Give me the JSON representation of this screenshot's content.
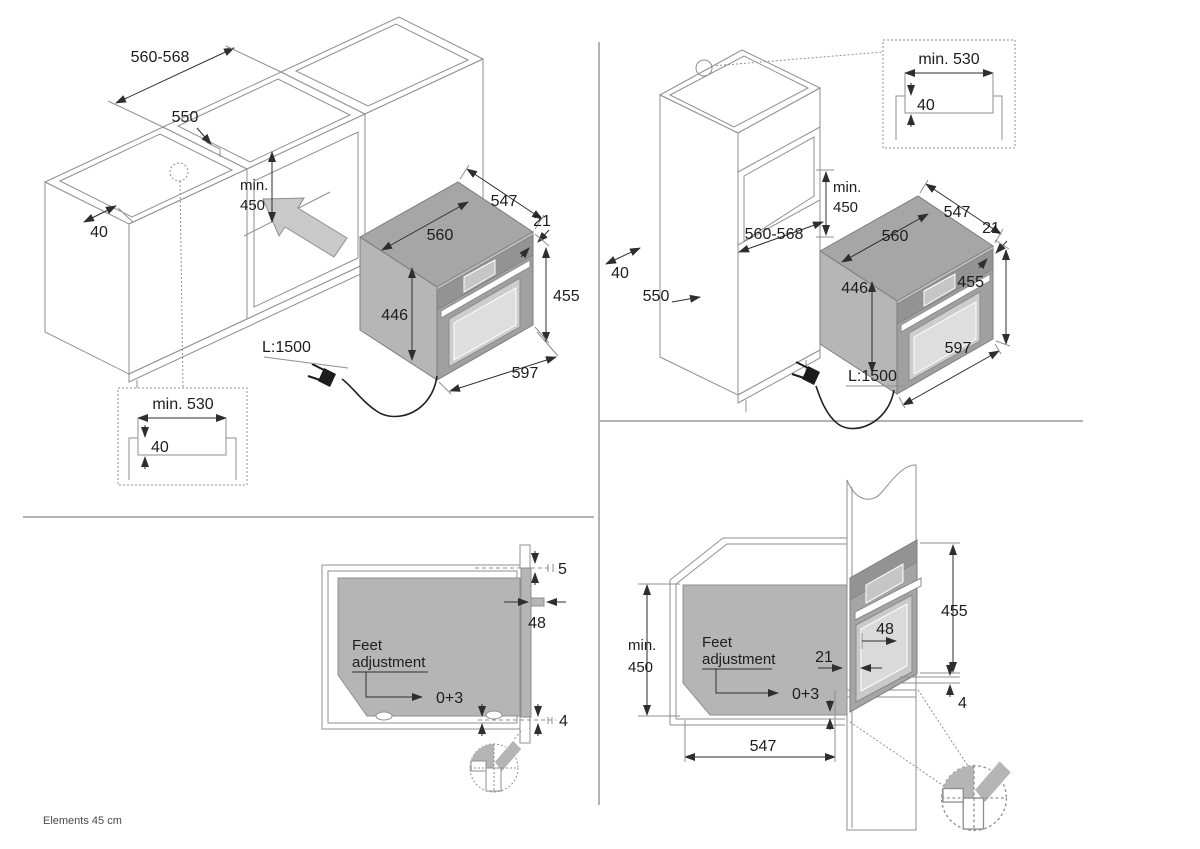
{
  "footer": {
    "note": "Elements 45 cm"
  },
  "colors": {
    "accent_gray": "#b5b5b5",
    "line_gray": "#8f8f8f",
    "dim_color": "#2e2e2e"
  },
  "top_left": {
    "niche_width": "560-568",
    "niche_depth": "550",
    "front_recess": "40",
    "min_label": "min.",
    "min_value": "450",
    "oven_depth": "547",
    "front_lip": "21",
    "oven_width": "560",
    "body_height": "446",
    "total_height": "455",
    "front_width": "597",
    "cord_length": "L:1500",
    "detail": {
      "width": "min. 530",
      "recess_depth": "40"
    }
  },
  "top_right": {
    "niche_height_label": "min.",
    "niche_height_value": "450",
    "niche_width": "560-568",
    "side_recess": "40",
    "niche_depth": "550",
    "oven_depth": "547",
    "front_lip": "21",
    "oven_width": "560",
    "body_height": "446",
    "total_height": "455",
    "front_width": "597",
    "cord_length": "L:1500",
    "detail": {
      "width": "min. 530",
      "recess_depth": "40"
    }
  },
  "bottom_left": {
    "top_gap": "5",
    "handle_projection": "48",
    "bottom_gap": "4",
    "feet_label_line1": "Feet",
    "feet_label_line2": "adjustment",
    "feet_range": "0+3"
  },
  "bottom_right": {
    "niche_height_label": "min.",
    "niche_height_value": "450",
    "total_height": "455",
    "handle_projection": "48",
    "front_lip": "21",
    "bottom_gap": "4",
    "oven_depth": "547",
    "feet_label_line1": "Feet",
    "feet_label_line2": "adjustment",
    "feet_range": "0+3"
  }
}
